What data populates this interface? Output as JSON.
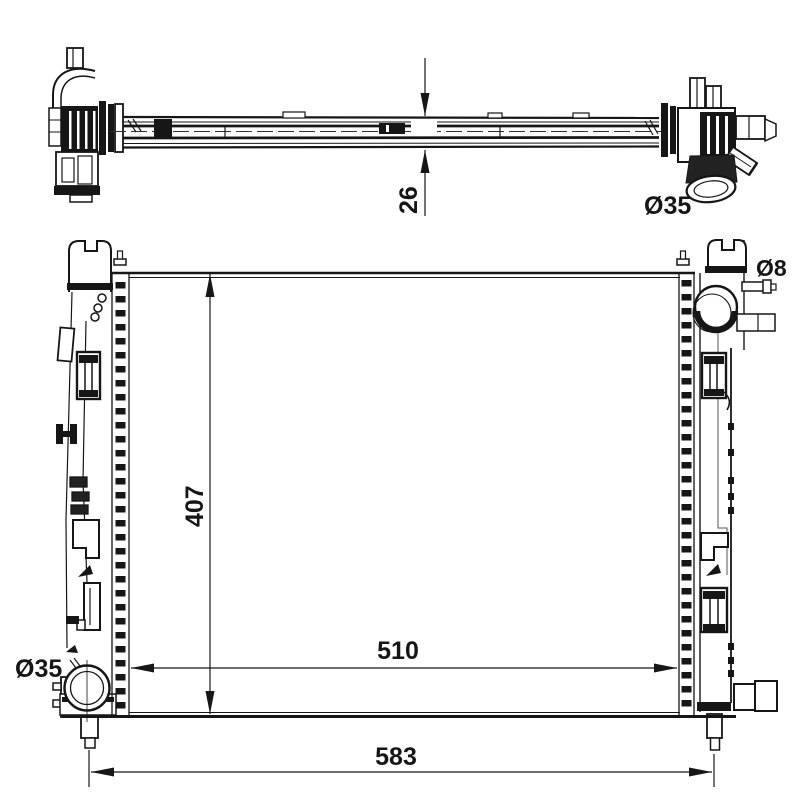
{
  "page": {
    "background": "#ffffff",
    "line_color": "#161616"
  },
  "top_view": {
    "thickness_dim_label": "26",
    "outlet_diameter_label": "Ø35"
  },
  "front_view": {
    "height_dim_label": "407",
    "tank_width_dim_label": "510",
    "overall_width_dim_label": "583",
    "bleed_pipe_diameter_label": "Ø8",
    "outlet_diameter_label": "Ø35"
  }
}
